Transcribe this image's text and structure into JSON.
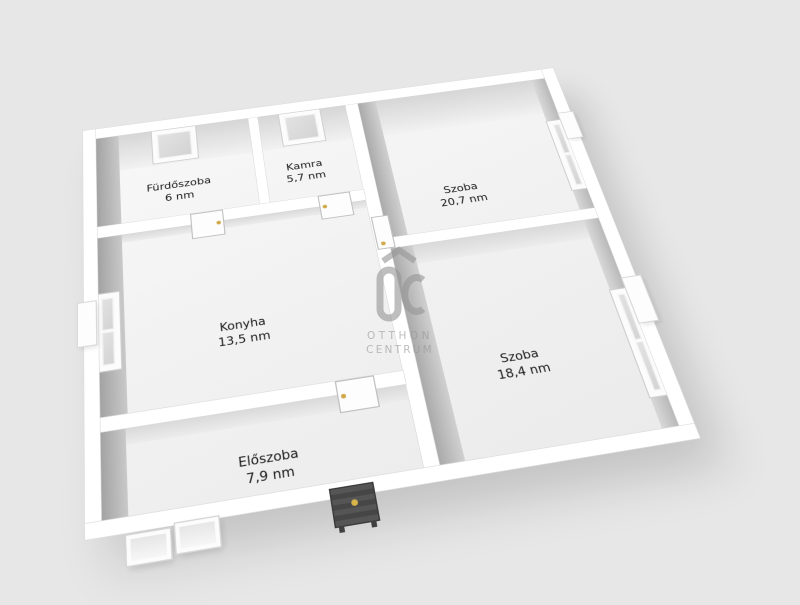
{
  "scene": {
    "background": "#e7e7e7",
    "kind": "3D floor plan render"
  },
  "rooms": [
    {
      "name": "Fürdőszoba",
      "area": "6 nm"
    },
    {
      "name": "Kamra",
      "area": "5,7 nm"
    },
    {
      "name": "Szoba",
      "area": "20,7 nm"
    },
    {
      "name": "Konyha",
      "area": "13,5 nm"
    },
    {
      "name": "Szoba",
      "area": "18,4 nm"
    },
    {
      "name": "Előszoba",
      "area": "7,9 nm"
    }
  ],
  "watermark": {
    "logo": "OC",
    "line1": "OTTHON",
    "line2": "CENTRUM"
  },
  "colors": {
    "background": "#e7e7e7",
    "wall_top": "#ffffff",
    "wall_shadow": "#a8a8a8",
    "floor": "#f2f2f2",
    "entrance_door": "#4c4c4c",
    "door_handle_gold": "#d0a948",
    "watermark_gray": "#969696",
    "label_text": "#1a1a1a"
  }
}
